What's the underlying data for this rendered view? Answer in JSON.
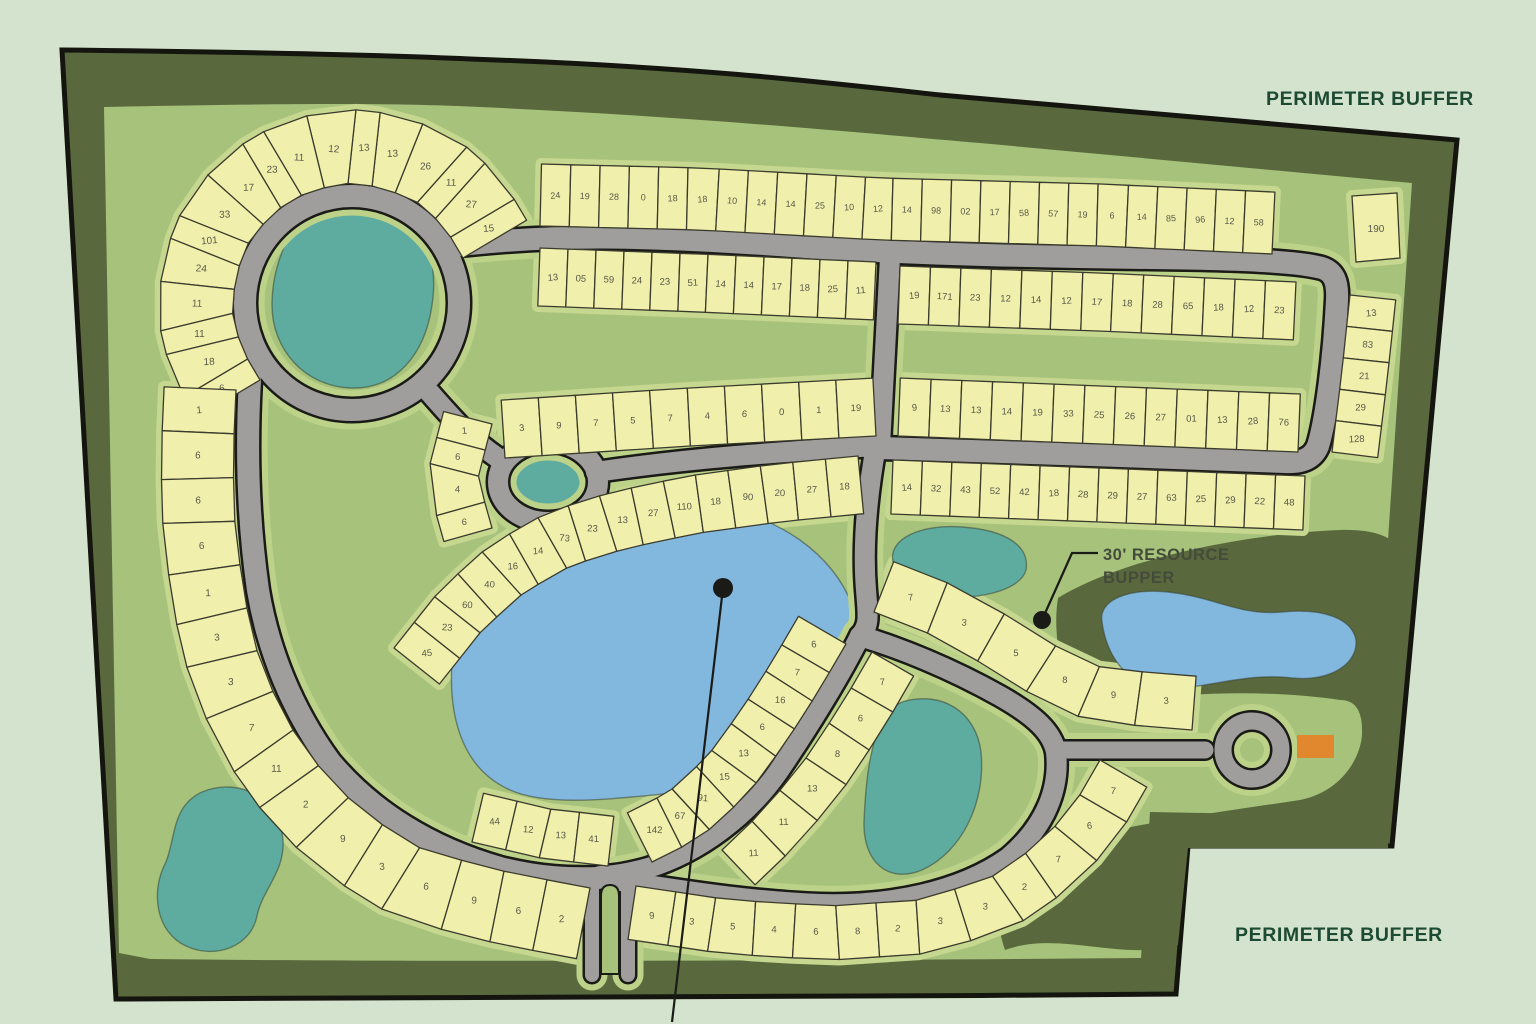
{
  "labels": {
    "perimeter_buffer_top": {
      "text": "PERIMETER BUFFER"
    },
    "perimeter_buffer_bottom": {
      "text": "PERIMETER BUFFER"
    },
    "resource_line1": {
      "text": "30' RESOURCE"
    },
    "resource_line2": {
      "text": "BUPPER"
    }
  },
  "colors": {
    "background": "#d4e3cd",
    "buffer_band": "#59683d",
    "field": "#a6c27b",
    "outline": "#15150f",
    "lot_fill": "#f1efac",
    "lot_stroke": "#3b3b2d",
    "lot_halo": "#c6d78f",
    "road_verge": "#bdd289",
    "road_fill": "#9f9e9c",
    "road_casing": "#1a1a16",
    "pond_teal": "#5dac9f",
    "pond_blue": "#82b7de",
    "pond_stroke": "#3a4636",
    "marker_orange": "#e1872e",
    "leader": "#1a1a17",
    "label_green": "#1d4a32",
    "label_gray": "#454b3b",
    "lot_number_color": "#585949"
  },
  "site": {
    "outer_path": "M 62,50 C 250,52 380,55 470,59 C 700,67 830,83 940,95 L 1457,140 L 1392,846 L 1188,846 L 1176,994 C 800,997 400,999 116,999 Z",
    "inner_path": "M 104,107 C 300,103 400,103 480,107 C 700,117 850,132 980,143 L 1412,183 C 1404,300 1396,420 1388,540 C 1382,640 1374,740 1368,816 L 1150,812 L 1141,958 C 800,961 400,962 150,959 L 119,953 Z",
    "resource_band_path": "M 1058,598 C 1120,560 1240,534 1340,530 C 1374,529 1390,537 1396,545 L 1388,848 L 1188,848 L 1178,945 C 1120,962 1060,930 1005,950 C 988,900 1002,868 1042,848 C 1120,825 1220,812 1300,800 C 1340,792 1360,760 1362,735 C 1363,710 1355,700 1340,700 C 1260,688 1150,692 1078,712 C 1062,680 1052,635 1058,598 Z"
  },
  "ponds": [
    {
      "id": "pond-top-left",
      "color": "teal",
      "d": "M 285,245 C 295,205 335,190 370,198 C 420,210 440,255 432,305 C 425,355 395,390 350,388 C 305,386 272,350 272,305 C 272,283 277,263 285,245 Z"
    },
    {
      "id": "pond-center-small",
      "color": "teal",
      "d": "M 510,478 C 513,456 535,448 557,452 C 580,457 588,473 582,492 C 575,509 549,514 528,507 C 514,501 508,491 510,478 Z"
    },
    {
      "id": "pond-big-blue",
      "color": "blue",
      "d": "M 560,518 C 640,482 740,498 800,540 C 850,576 872,630 856,692 C 842,748 790,788 718,790 C 650,792 560,812 510,790 C 465,770 448,722 452,662 C 456,600 500,545 560,518 Z"
    },
    {
      "id": "pond-mid-teal",
      "color": "teal",
      "d": "M 893,562 C 888,538 922,524 962,527 C 1006,530 1030,546 1026,570 C 1020,592 972,601 937,596 C 908,592 896,580 893,562 Z"
    },
    {
      "id": "pond-buffer-blue",
      "color": "blue",
      "d": "M 1102,622 C 1098,600 1128,588 1168,592 C 1215,597 1240,616 1282,612 C 1322,608 1352,618 1356,640 C 1358,664 1330,682 1292,678 C 1244,672 1205,690 1164,688 C 1124,686 1106,652 1102,622 Z"
    },
    {
      "id": "pond-bottom-teal",
      "color": "teal",
      "d": "M 902,702 C 942,690 976,712 981,752 C 986,802 962,852 922,870 C 888,884 863,862 864,822 C 866,772 872,716 902,702 Z"
    },
    {
      "id": "pond-left-teal",
      "color": "teal",
      "d": "M 202,792 C 242,776 280,800 283,840 C 285,872 262,890 257,916 C 251,946 216,960 186,946 C 156,932 150,892 166,862 C 176,836 172,806 202,792 Z"
    }
  ],
  "roads": [
    {
      "id": "ring-top-left",
      "type": "circle",
      "cx": 352,
      "cy": 303,
      "r": 107,
      "w": 22
    },
    {
      "id": "loop-small",
      "type": "ellipse",
      "cx": 548,
      "cy": 482,
      "rx": 50,
      "ry": 40,
      "w": 20
    },
    {
      "id": "road-top",
      "type": "path",
      "w": 22,
      "d": "M 452,246 C 560,233 660,236 820,248 C 920,254 1050,257 1150,258 C 1250,259 1300,262 1322,268 C 1334,272 1338,282 1337,300 C 1334,360 1326,420 1318,446 C 1313,458 1303,463 1285,462 C 1160,457 1000,452 880,448"
    },
    {
      "id": "road-connector",
      "type": "path",
      "w": 20,
      "d": "M 890,257 L 880,446"
    },
    {
      "id": "road-diagonal",
      "type": "path",
      "w": 20,
      "d": "M 430,393 C 458,425 472,440 498,458"
    },
    {
      "id": "road-central",
      "type": "path",
      "w": 20,
      "d": "M 596,472 C 690,458 780,452 876,446"
    },
    {
      "id": "road-west-loop",
      "type": "path",
      "w": 22,
      "d": "M 250,380 C 246,450 248,520 258,590 C 268,650 292,710 330,762 C 372,812 430,848 500,868 C 540,878 570,879 598,878"
    },
    {
      "id": "road-south-spine",
      "type": "path",
      "w": 20,
      "d": "M 876,446 C 868,490 862,540 866,590 C 868,615 870,626 860,636"
    },
    {
      "id": "road-branch-sw",
      "type": "path",
      "w": 20,
      "d": "M 860,636 C 842,672 812,722 778,772 C 748,815 700,852 648,868 C 630,873 612,876 600,876"
    },
    {
      "id": "road-pond-loop",
      "type": "path",
      "w": 20,
      "d": "M 860,636 C 900,648 950,668 1000,696 C 1035,716 1052,732 1056,752 C 1060,788 1046,826 1008,858 C 960,892 890,906 820,904 C 740,901 670,888 600,878"
    },
    {
      "id": "road-culdesac-stem",
      "type": "path",
      "w": 17,
      "d": "M 1056,750 L 1205,750"
    },
    {
      "id": "road-culdesac-ring",
      "type": "ring",
      "cx": 1252,
      "cy": 750,
      "r": 29,
      "w": 17
    },
    {
      "id": "entrance-lane-west",
      "type": "path",
      "w": 14,
      "d": "M 592,880 L 592,975"
    },
    {
      "id": "entrance-lane-east",
      "type": "path",
      "w": 14,
      "d": "M 628,880 L 628,975"
    }
  ],
  "median": {
    "d": "M 601,974 L 601,896 Q 601,885 610,885 Q 619,885 619,896 L 619,974 Z"
  },
  "strips": [
    {
      "id": "fan-ring-top-left",
      "depth": 74,
      "side": 1,
      "fs": 10,
      "pts": [
        [
          463,
          258
        ],
        [
          444,
          226
        ],
        [
          416,
          201
        ],
        [
          381,
          187
        ],
        [
          344,
          183
        ],
        [
          307,
          192
        ],
        [
          275,
          211
        ],
        [
          250,
          239
        ],
        [
          236,
          274
        ],
        [
          232,
          311
        ],
        [
          241,
          348
        ],
        [
          260,
          380
        ]
      ],
      "numbers": [
        "15",
        "27",
        "11",
        "26",
        "13",
        "13",
        "12",
        "11",
        "23",
        "17",
        "33",
        "101",
        "24",
        "11",
        "11",
        "18",
        "6"
      ]
    },
    {
      "id": "arc-west",
      "depth": 72,
      "side": 1,
      "fs": 10,
      "pts": [
        [
          236,
          390
        ],
        [
          233,
          460
        ],
        [
          235,
          530
        ],
        [
          245,
          600
        ],
        [
          258,
          655
        ],
        [
          283,
          716
        ],
        [
          320,
          768
        ],
        [
          362,
          812
        ],
        [
          420,
          848
        ],
        [
          488,
          868
        ],
        [
          548,
          880
        ],
        [
          590,
          888
        ]
      ],
      "numbers": [
        "1",
        "6",
        "6",
        "6",
        "1",
        "3",
        "3",
        "7",
        "11",
        "2",
        "9",
        "3",
        "6",
        "9",
        "6",
        "2"
      ]
    },
    {
      "id": "row-top-north",
      "depth": 62,
      "side": -1,
      "fs": 9,
      "pts": [
        [
          540,
          226
        ],
        [
          700,
          230
        ],
        [
          880,
          240
        ],
        [
          1100,
          246
        ],
        [
          1272,
          254
        ]
      ],
      "numbers": [
        "24",
        "19",
        "28",
        "0",
        "18",
        "18",
        "10",
        "14",
        "14",
        "25",
        "10",
        "12",
        "14",
        "98",
        "02",
        "17",
        "58",
        "57",
        "19",
        "6",
        "14",
        "85",
        "96",
        "12",
        "58"
      ]
    },
    {
      "id": "row-top-south-west",
      "depth": 58,
      "side": 1,
      "fs": 9.5,
      "pts": [
        [
          540,
          248
        ],
        [
          700,
          254
        ],
        [
          876,
          262
        ]
      ],
      "numbers": [
        "13",
        "05",
        "59",
        "24",
        "23",
        "51",
        "14",
        "14",
        "17",
        "18",
        "25",
        "11"
      ]
    },
    {
      "id": "row-central-north",
      "depth": 58,
      "side": -1,
      "fs": 9.5,
      "pts": [
        [
          505,
          458
        ],
        [
          690,
          446
        ],
        [
          876,
          436
        ]
      ],
      "numbers": [
        "3",
        "9",
        "7",
        "5",
        "7",
        "4",
        "6",
        "0",
        "1",
        "19"
      ]
    },
    {
      "id": "block-east-upper",
      "depth": 58,
      "side": 1,
      "fs": 9.5,
      "pts": [
        [
          900,
          266
        ],
        [
          1100,
          273
        ],
        [
          1296,
          282
        ]
      ],
      "numbers": [
        "19",
        "171",
        "23",
        "12",
        "14",
        "12",
        "17",
        "18",
        "28",
        "65",
        "18",
        "12",
        "23"
      ]
    },
    {
      "id": "block-east-lower",
      "depth": 58,
      "side": -1,
      "fs": 9.5,
      "pts": [
        [
          898,
          436
        ],
        [
          1100,
          444
        ],
        [
          1298,
          452
        ]
      ],
      "numbers": [
        "9",
        "13",
        "13",
        "14",
        "19",
        "33",
        "25",
        "26",
        "27",
        "01",
        "13",
        "28",
        "76"
      ]
    },
    {
      "id": "row-second-south",
      "depth": 54,
      "side": 1,
      "fs": 9.5,
      "pts": [
        [
          893,
          460
        ],
        [
          1100,
          468
        ],
        [
          1305,
          476
        ]
      ],
      "numbers": [
        "14",
        "32",
        "43",
        "52",
        "42",
        "18",
        "28",
        "29",
        "27",
        "63",
        "25",
        "29",
        "22",
        "48"
      ]
    },
    {
      "id": "column-far-east",
      "depth": 46,
      "side": -1,
      "fs": 9.5,
      "pts": [
        [
          1350,
          295
        ],
        [
          1342,
          370
        ],
        [
          1332,
          452
        ]
      ],
      "numbers": [
        "13",
        "83",
        "21",
        "29",
        "128"
      ]
    },
    {
      "id": "arc-pond-northwest",
      "depth": 58,
      "side": 1,
      "fs": 9.5,
      "pts": [
        [
          394,
          648
        ],
        [
          440,
          590
        ],
        [
          490,
          545
        ],
        [
          548,
          512
        ],
        [
          612,
          492
        ],
        [
          688,
          476
        ],
        [
          775,
          464
        ],
        [
          858,
          456
        ]
      ],
      "numbers": [
        "45",
        "23",
        "60",
        "40",
        "16",
        "14",
        "73",
        "23",
        "13",
        "27",
        "110",
        "18",
        "90",
        "20",
        "27",
        "18"
      ]
    },
    {
      "id": "wedge-loop-west",
      "depth": 50,
      "side": 1,
      "fs": 9.5,
      "pts": [
        [
          492,
          424
        ],
        [
          478,
          478
        ],
        [
          492,
          528
        ]
      ],
      "numbers": [
        "1",
        "6",
        "4",
        "6"
      ]
    },
    {
      "id": "arc-inner-southwest",
      "depth": 55,
      "side": 1,
      "fs": 9.5,
      "pts": [
        [
          846,
          644
        ],
        [
          818,
          692
        ],
        [
          786,
          742
        ],
        [
          748,
          794
        ],
        [
          700,
          838
        ],
        [
          652,
          862
        ]
      ],
      "numbers": [
        "6",
        "7",
        "16",
        "6",
        "13",
        "15",
        "91",
        "67",
        "142"
      ]
    },
    {
      "id": "arc-bottom-outer",
      "depth": 54,
      "side": 1,
      "fs": 9.5,
      "pts": [
        [
          636,
          886
        ],
        [
          730,
          900
        ],
        [
          830,
          906
        ],
        [
          920,
          900
        ],
        [
          990,
          878
        ],
        [
          1042,
          842
        ],
        [
          1078,
          798
        ],
        [
          1100,
          760
        ]
      ],
      "numbers": [
        "9",
        "3",
        "5",
        "4",
        "6",
        "8",
        "2",
        "3",
        "3",
        "2",
        "7",
        "6",
        "7"
      ]
    },
    {
      "id": "wedge-pond-west",
      "depth": 48,
      "side": -1,
      "fs": 9.5,
      "pts": [
        [
          872,
          652
        ],
        [
          842,
          704
        ],
        [
          806,
          758
        ],
        [
          764,
          810
        ],
        [
          722,
          850
        ]
      ],
      "numbers": [
        "7",
        "6",
        "8",
        "13",
        "11",
        "11"
      ]
    },
    {
      "id": "arc-resource-north",
      "depth": 54,
      "side": -1,
      "fs": 9.5,
      "pts": [
        [
          874,
          612
        ],
        [
          930,
          634
        ],
        [
          990,
          668
        ],
        [
          1040,
          700
        ],
        [
          1082,
          718
        ],
        [
          1140,
          726
        ],
        [
          1192,
          730
        ]
      ],
      "numbers": [
        "7",
        "3",
        "5",
        "8",
        "9",
        "3"
      ]
    },
    {
      "id": "row-entrance-west",
      "depth": 50,
      "side": -1,
      "fs": 9.5,
      "pts": [
        [
          472,
          842
        ],
        [
          540,
          858
        ],
        [
          608,
          866
        ]
      ],
      "numbers": [
        "44",
        "12",
        "13",
        "41"
      ]
    }
  ],
  "single_lots": [
    {
      "id": "lot-190",
      "points": "1352,196 1397,193 1400,258 1356,262",
      "number": "190",
      "nx": 1376,
      "ny": 232
    }
  ],
  "markers": {
    "dots": [
      {
        "id": "dot-big-pond",
        "x": 723,
        "y": 588,
        "r": 10
      },
      {
        "id": "dot-resource",
        "x": 1042,
        "y": 620,
        "r": 9
      }
    ],
    "leaders": [
      {
        "id": "leader-big-pond",
        "d": "M 723,588 L 672,1022"
      },
      {
        "id": "leader-resource",
        "d": "M 1042,620 L 1072,553 L 1098,553"
      }
    ],
    "orange_rect": {
      "x": 1297,
      "y": 735,
      "w": 37,
      "h": 23
    }
  }
}
